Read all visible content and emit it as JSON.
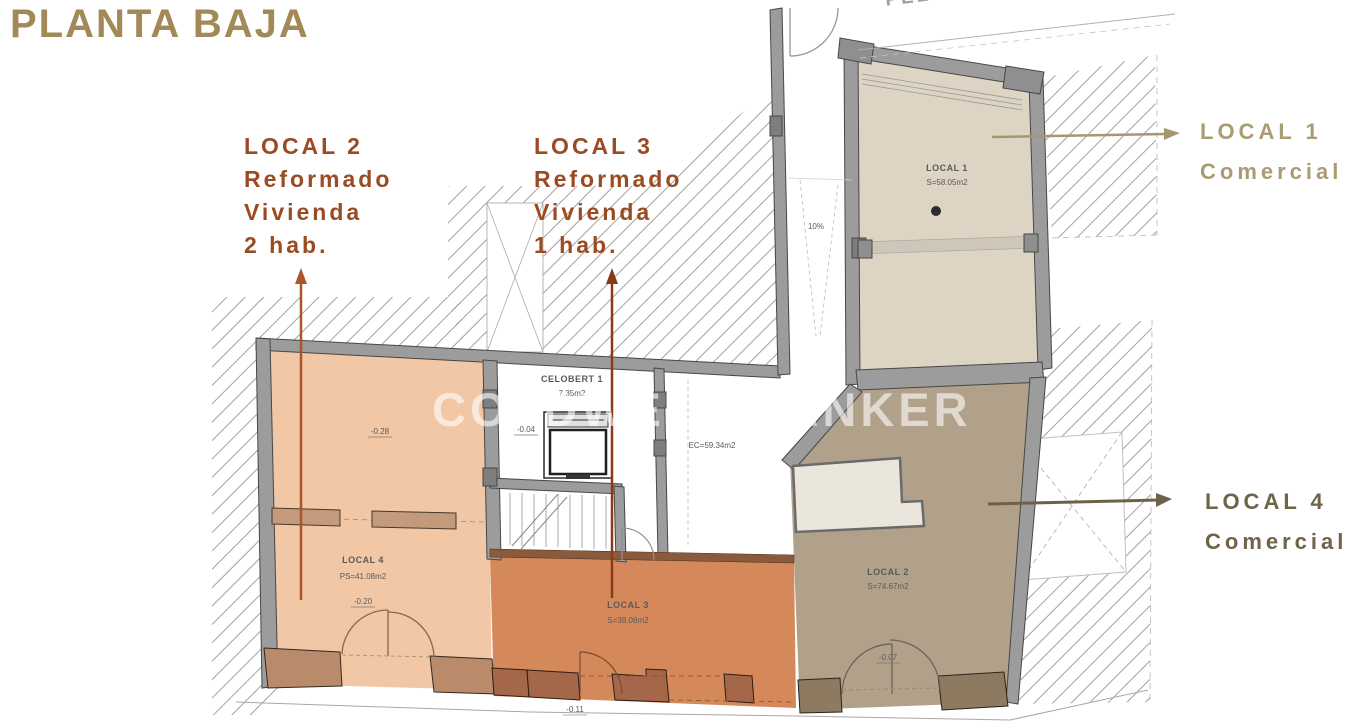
{
  "title": "PLANTA BAJA",
  "street_label": "PELLISSER",
  "watermark_text": "COLDWELL BANKER",
  "callouts": {
    "local2": {
      "title": "LOCAL 2",
      "line2": "Reformado",
      "line3": "Vivienda",
      "line4": "2 hab."
    },
    "local3": {
      "title": "LOCAL 3",
      "line2": "Reformado",
      "line3": "Vivienda",
      "line4": "1 hab."
    },
    "local1": {
      "title": "LOCAL 1",
      "line2": "Comercial"
    },
    "local4": {
      "title": "LOCAL 4",
      "line2": "Comercial"
    }
  },
  "plan_labels": {
    "local1_name": "LOCAL 1",
    "local1_area": "S=58.05m2",
    "local2_name": "LOCAL 2",
    "local2_area": "S=74.67m2",
    "local2_elev": "-0.07",
    "local3_name": "LOCAL 3",
    "local3_area": "S=38.08m2",
    "local4_name": "LOCAL 4",
    "local4_area": "PS=41.08m2",
    "local4_elev": "-0.20",
    "celobert_name": "CELOBERT 1",
    "celobert_area": "7.35m2",
    "celobert_elev": "-0.04",
    "corridor_area": "EC=59.34m2",
    "ramp_slope": "10%",
    "entry_elev": "-0.28",
    "street_elev": "-0.11"
  },
  "colors": {
    "title": "#a28a58",
    "callout_rust": "#9a4b21",
    "callout_tan": "#ab9b74",
    "callout_olive": "#6f6349",
    "room_peach": "#f2c7a6",
    "room_orange": "#d5885a",
    "room_brown": "#b1a18b",
    "room_beige": "#ded4c3",
    "wall_gray": "#9c9c9c"
  }
}
